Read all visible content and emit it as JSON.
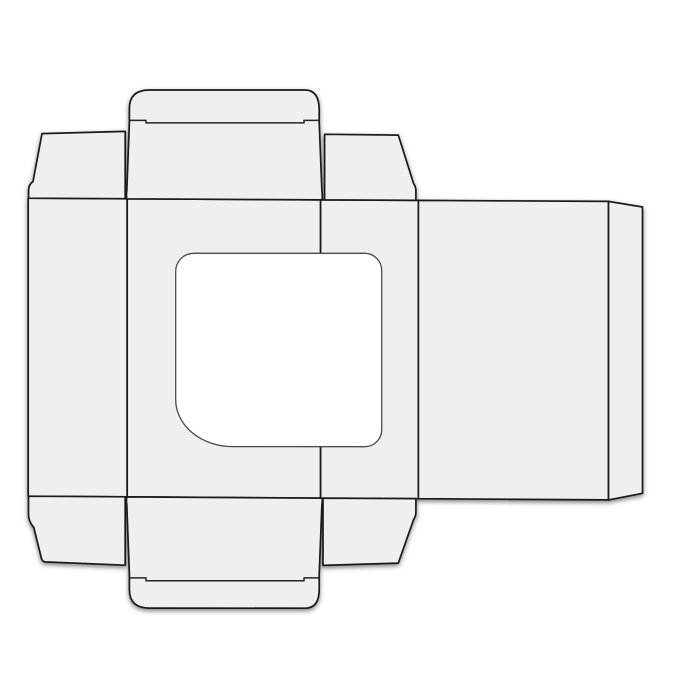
{
  "canvas": {
    "width": 700,
    "height": 700,
    "background": "#ffffff"
  },
  "style": {
    "panel_fill": "#efefef",
    "cut_stroke": "#1a1a1a",
    "fold_stroke": "#242424",
    "window_stroke": "#4a4a4a",
    "window_fill": "#ffffff",
    "cut_width": 1.7,
    "fold_width": 1.5,
    "window_width": 1.3
  },
  "dieline": {
    "name": "tuck-end-box-dieline-with-window",
    "shapes": [
      {
        "name": "side-panel-left",
        "kind": "panel",
        "path": "M 28.2 198.2 L 127.2 198.8 L 127.2 496.8 L 28.2 496.2 Z"
      },
      {
        "name": "front-panel",
        "kind": "panel",
        "path": "M 127.2 198.8 L 320.6 199.8 L 320.6 498.1 L 127.2 496.8 Z"
      },
      {
        "name": "side-panel-right",
        "kind": "panel",
        "path": "M 320.6 199.8 L 418.4 200.4 L 418.4 498.7 L 320.6 498.1 Z"
      },
      {
        "name": "back-panel",
        "kind": "panel",
        "path": "M 418.4 200.4 L 608.5 201.4 L 608.5 499.9 L 418.4 498.7 Z"
      },
      {
        "name": "glue-flap",
        "kind": "panel",
        "path": "M 608.5 201.4 L 642.5 207.0 L 642.5 493.3 L 608.5 499.9 Z"
      },
      {
        "name": "dust-flap-top-left",
        "kind": "panel",
        "path": "M 125.2 198.7 L 125.2 131.4 L 42.0 133.6 L 33.0 181.5 Q 28.6 184.5 28.6 190.5 L 28.6 198.2 Z"
      },
      {
        "name": "dust-flap-top-right",
        "kind": "panel",
        "path": "M 324.6 199.9 L 324.6 134.3 L 398.3 135.1 L 413.6 183.6 Q 415.9 186.5 415.9 191.0 L 415.9 200.3 Z"
      },
      {
        "name": "tuck-panel-and-flap-top",
        "kind": "panel",
        "path": "M 126.7 198.8 Q 126.2 194.0 126.8 191.0 L 129.4 122.5 L 129.4 108.5 Q 129.4 90.0 149.5 90.0 L 305.0 90.0 Q 319.2 90.0 319.2 110.0 L 319.2 122.5 L 321.9 191.0 Q 322.5 194.0 322.1 199.9 Z"
      },
      {
        "name": "tuck-panel-and-flap-bottom",
        "kind": "panel",
        "path": "M 126.7 496.9 Q 126.2 501.7 126.8 504.7 L 129.4 574.4 L 129.4 589.5 Q 129.4 608.1 149.5 608.1 L 305.0 608.2 Q 319.2 608.2 319.2 589.5 L 319.2 574.4 L 321.9 504.7 Q 322.5 501.7 322.1 498.2 Z"
      },
      {
        "name": "dust-flap-bottom-left",
        "kind": "panel",
        "path": "M 125.2 496.8 L 125.2 565.2 L 44.5 561.9 Q 41.6 560.6 41.0 556.6 L 33.8 527.5 Q 28.5 521.5 28.5 514.0 L 28.5 496.2 Z"
      },
      {
        "name": "dust-flap-bottom-right",
        "kind": "panel",
        "path": "M 323.0 498.2 L 323.0 565.4 L 398.3 563.1 L 413.6 519.5 Q 415.9 516.5 415.9 512.0 L 415.9 498.6 Z"
      },
      {
        "name": "tuck-flap-fold-top",
        "kind": "fold",
        "path": "M 129.4 120.4 L 146.0 120.4 L 146.0 122.9 L 304.0 122.9 L 304.0 120.4 L 319.2 120.4"
      },
      {
        "name": "tuck-flap-fold-bottom",
        "kind": "fold",
        "path": "M 129.4 577.9 L 146.0 577.9 L 146.0 580.8 L 304.0 580.8 L 304.0 577.9 L 319.2 577.9"
      },
      {
        "name": "window-cutout",
        "kind": "window",
        "path": "M 193.7 253.3 L 364.7 253.3 A 17 17 0 0 1 381.7 270.3 L 381.7 429.7 A 17 17 0 0 1 364.7 446.7 L 232.0 446.6 A 57 47 0 0 1 175.7 399.2 L 175.7 271.3 A 18 18 0 0 1 193.7 253.3 Z"
      }
    ]
  }
}
